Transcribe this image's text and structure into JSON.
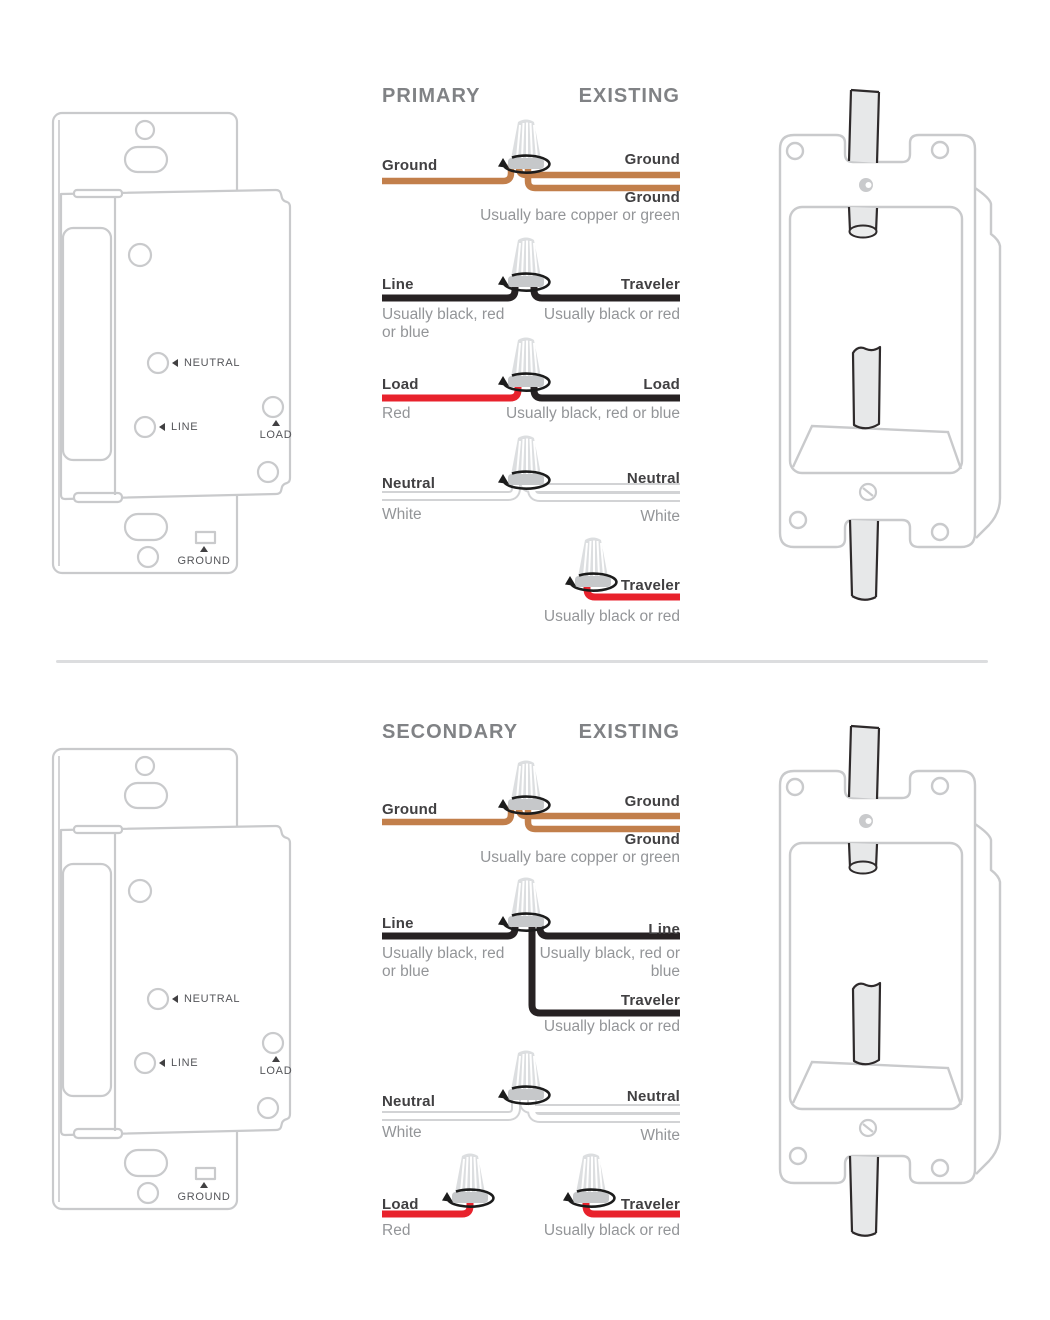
{
  "switch_labels": {
    "neutral": "NEUTRAL",
    "line": "LINE",
    "load": "LOAD",
    "ground": "GROUND"
  },
  "colors": {
    "ground_wire": "#c27f4b",
    "load_wire_red": "#e8222c",
    "line_wire_black": "#272223",
    "neutral_wire_white": "#ffffff",
    "illustration_outline": "#c9cacc",
    "header_gray": "#808285",
    "label_dark": "#414042",
    "sub_gray": "#939598"
  },
  "sections": [
    {
      "left_header": "PRIMARY",
      "right_header": "EXISTING",
      "rows": {
        "ground": {
          "left": "Ground",
          "right_top": "Ground",
          "right_bottom": "Ground",
          "sub": "Usually bare copper or green"
        },
        "line": {
          "left": "Line",
          "right": "Traveler",
          "left_sub": "Usually black, red or blue",
          "right_sub": "Usually black or red"
        },
        "load": {
          "left": "Load",
          "right": "Load",
          "left_sub": "Red",
          "right_sub": "Usually black, red or blue"
        },
        "neutral": {
          "left": "Neutral",
          "right": "Neutral",
          "left_sub": "White",
          "right_sub": "White"
        },
        "traveler": {
          "label": "Traveler",
          "sub": "Usually black or red"
        }
      }
    },
    {
      "left_header": "SECONDARY",
      "right_header": "EXISTING",
      "rows": {
        "ground": {
          "left": "Ground",
          "right_top": "Ground",
          "right_bottom": "Ground",
          "sub": "Usually bare copper or green"
        },
        "line": {
          "left": "Line",
          "right": "Line",
          "left_sub": "Usually black, red or blue",
          "right_sub": "Usually black, red or blue",
          "traveler": "Traveler",
          "traveler_sub": "Usually black or red"
        },
        "neutral": {
          "left": "Neutral",
          "right": "Neutral",
          "left_sub": "White",
          "right_sub": "White"
        },
        "load": {
          "label": "Load",
          "sub": "Red"
        },
        "traveler": {
          "label": "Traveler",
          "sub": "Usually black or red"
        }
      }
    }
  ]
}
